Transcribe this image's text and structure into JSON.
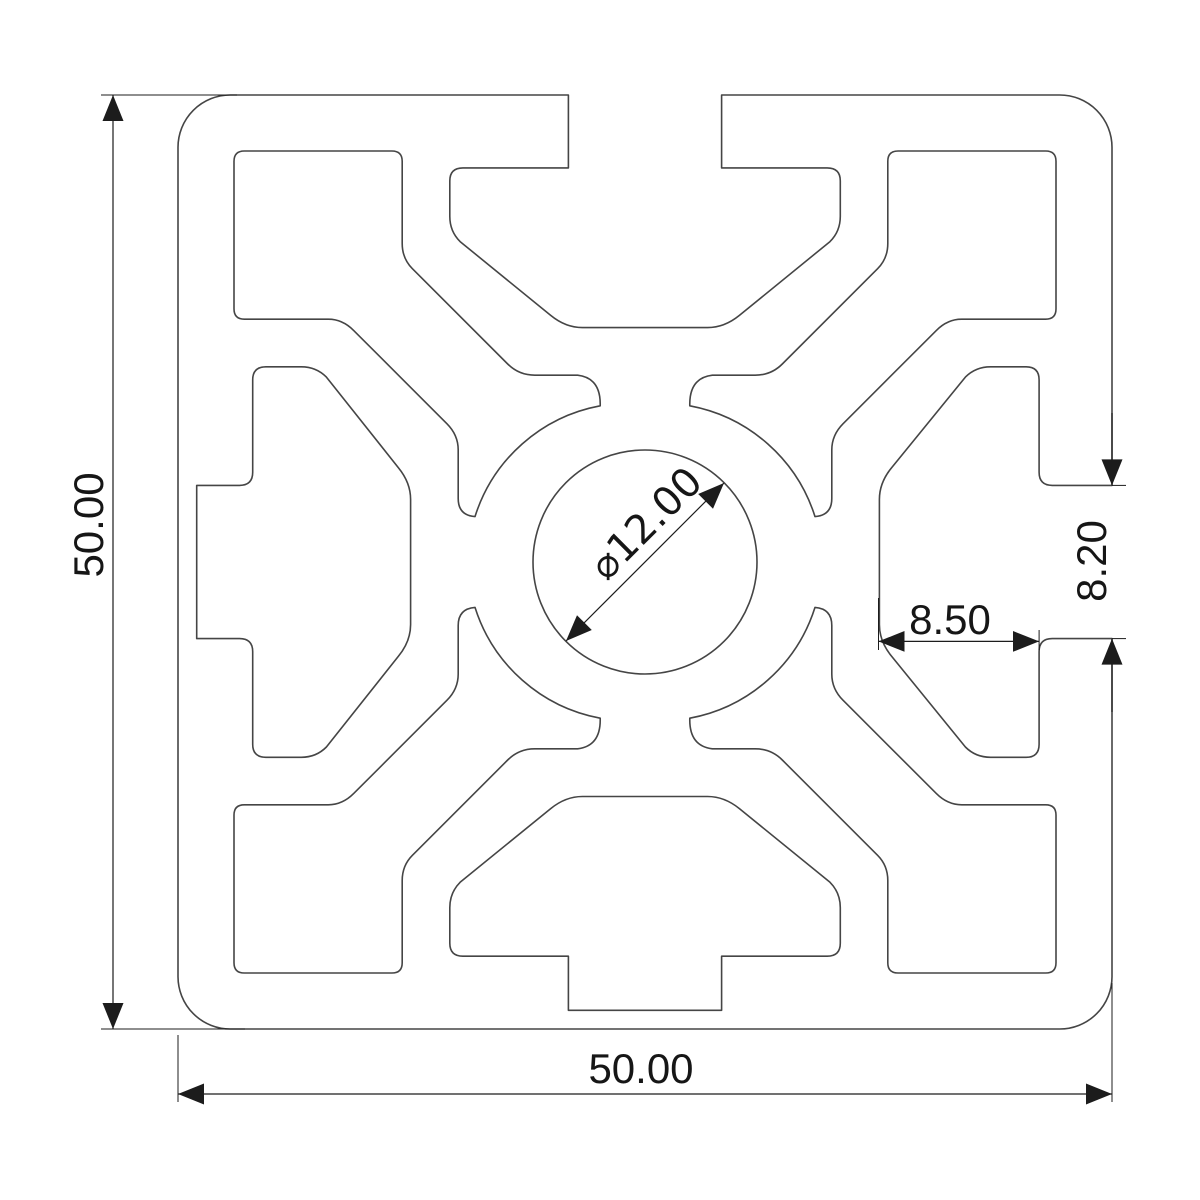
{
  "drawing": {
    "type": "technical-cross-section",
    "subject": "aluminium-extrusion-profile",
    "colors": {
      "background": "#ffffff",
      "profile_line": "#454545",
      "dimension_line": "#1c1c1c",
      "text": "#161616"
    },
    "dimensions": {
      "overall_height": {
        "label": "50.00"
      },
      "overall_width": {
        "label": "50.00"
      },
      "slot_depth": {
        "label": "8.50"
      },
      "slot_opening": {
        "label": "8.20"
      },
      "center_bore": {
        "label": "⌀12.00"
      }
    }
  }
}
